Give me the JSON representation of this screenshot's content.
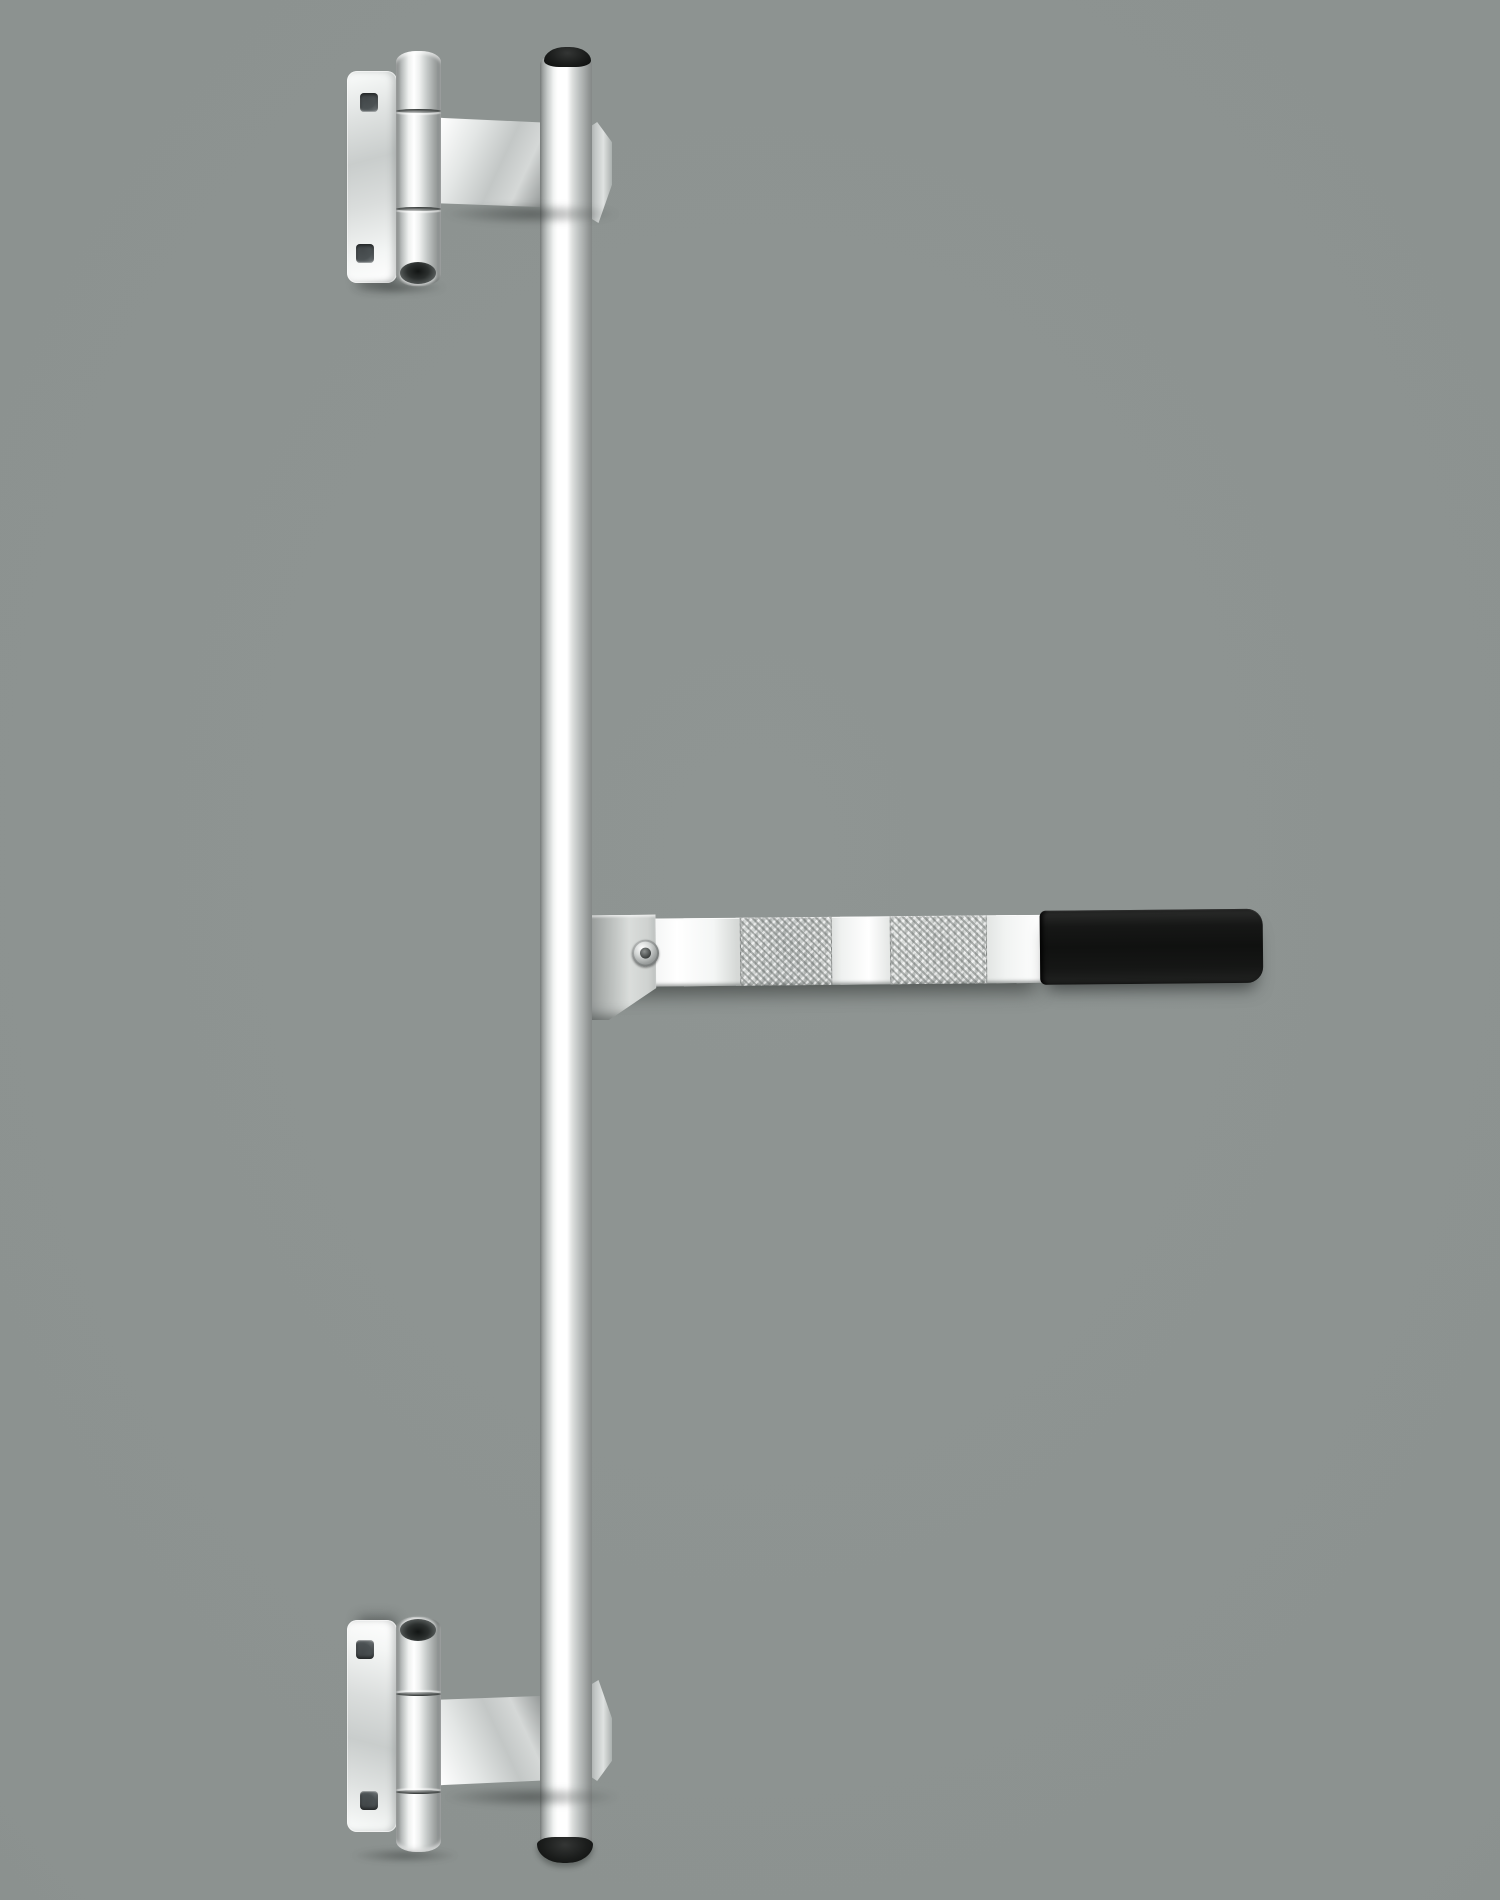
{
  "meta": {
    "type": "product-photo",
    "description": "Stainless steel cargo trailer door lock rod assembly: a long vertical lock tube with black end caps, two bolt-on door hinges with mounting plates, and a horizontal cam handle with a black rubber grip, photographed on a plain gray studio background."
  },
  "product": {
    "parts": [
      {
        "id": "lock-rod",
        "label": "Vertical lock rod tube"
      },
      {
        "id": "rod-end-cap-top",
        "label": "Black rod end cap (top)"
      },
      {
        "id": "rod-end-cap-bottom",
        "label": "Black rod end cap (bottom)"
      },
      {
        "id": "top-hinge",
        "label": "Upper door hinge with mounting plate"
      },
      {
        "id": "bottom-hinge",
        "label": "Lower door hinge with mounting plate"
      },
      {
        "id": "mounting-plate",
        "label": "Hinge mounting plate with two square bolt holes"
      },
      {
        "id": "hinge-barrel",
        "label": "Hinge barrel with pin"
      },
      {
        "id": "hinge-bracket",
        "label": "Hinge leaf bracket welded to rod"
      },
      {
        "id": "handle-strap",
        "label": "Flat steel locking handle"
      },
      {
        "id": "handle-screw",
        "label": "Handle pivot screw"
      },
      {
        "id": "handle-grip",
        "label": "Black rubber handle grip"
      }
    ]
  },
  "colors": {
    "background": "#8c9290",
    "steel_white": "#ffffff",
    "steel_light": "#e7e9e8",
    "steel_mid": "#c3c7c6",
    "steel_dim": "#9da1a0",
    "steel_dark": "#7a7e7d",
    "seam_dark": "#2e3231",
    "hole_dark": "#4b5153",
    "cap_black": "#1b1d1c",
    "grip_black": "#101110",
    "shadow": "rgba(33,38,37,0.45)"
  }
}
